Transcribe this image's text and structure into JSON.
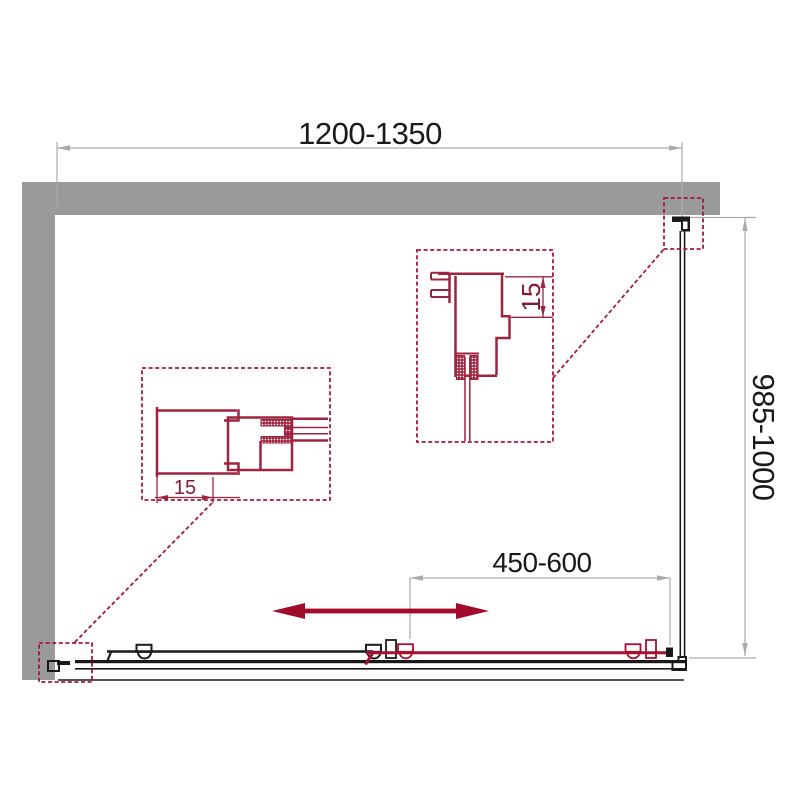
{
  "drawing": {
    "type": "shower-enclosure-technical-plan",
    "dimensions": {
      "width": {
        "label": "1200-1350"
      },
      "depth": {
        "label": "985-1000"
      },
      "door_travel": {
        "label": "450-600"
      },
      "left_profile_adjustment": {
        "label": "15"
      },
      "top_profile_adjustment": {
        "label": "15"
      }
    },
    "colors": {
      "wall_gray": "#9a9a9a",
      "dimension_gray": "#ababab",
      "line_black": "#1a1a1a",
      "profile_red": "#9e233e",
      "door_red": "#a5122f",
      "arrow_red": "#a30b2d",
      "callout_red": "#a6173b",
      "text_black": "#1a1a1a"
    }
  }
}
